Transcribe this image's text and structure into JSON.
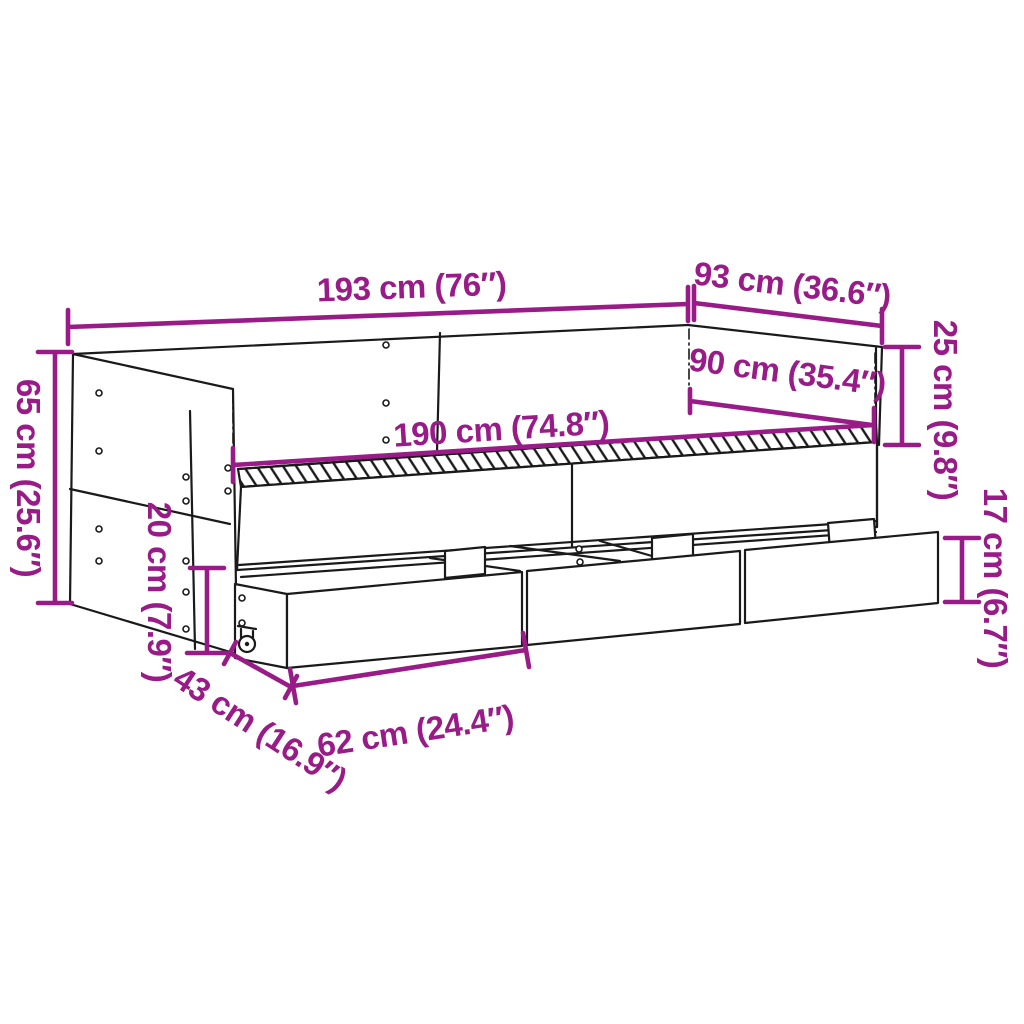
{
  "figure": {
    "subject": "daybed-with-storage-drawers-dimension-diagram",
    "background": "#ffffff",
    "colors": {
      "dimension": "#991B87",
      "line": "#1a1a1a"
    }
  },
  "measurements": {
    "overall_length": "193 cm (76″)",
    "overall_depth": "93 cm (36.6″)",
    "backrest_height": "25 cm (9.8″)",
    "inner_depth": "90 cm (35.4″)",
    "inner_length": "190 cm (74.8″)",
    "side_height": "65 cm (25.6″)",
    "frame_height": "20 cm (7.9″)",
    "drawer_height": "17 cm (6.7″)",
    "drawer_depth": "43 cm (16.9″)",
    "drawer_length": "62 cm (24.4″)"
  }
}
